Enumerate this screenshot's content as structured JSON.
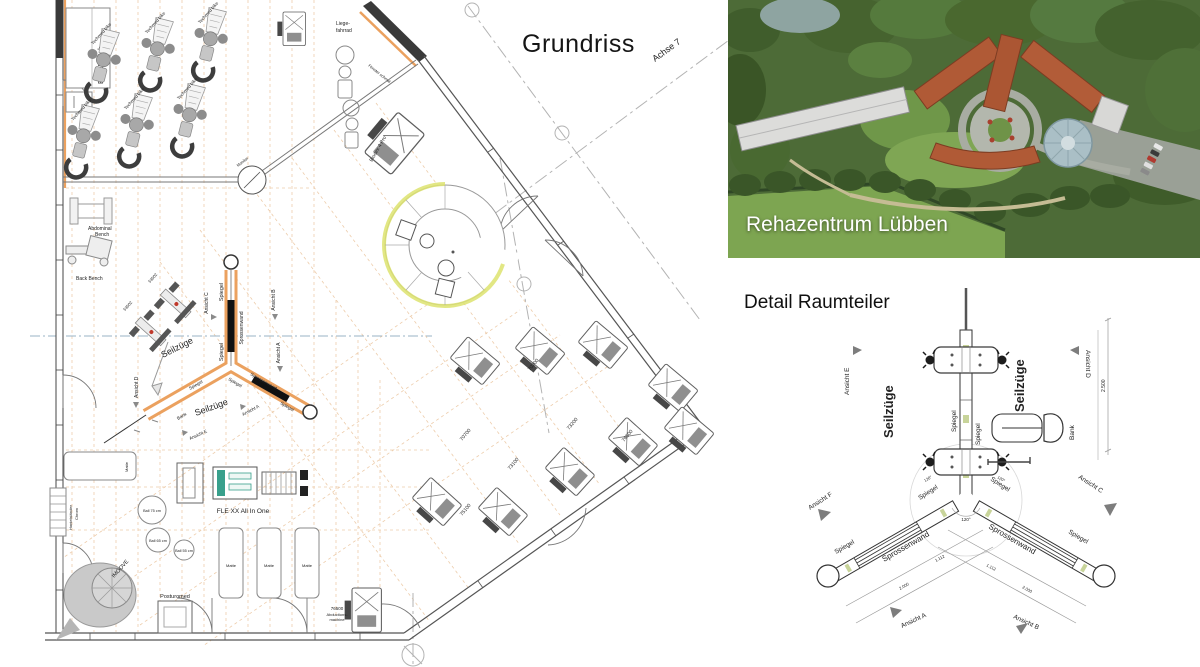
{
  "fp": {
    "title": "Grundriss",
    "achse": "Achse 7",
    "elt": "ELT-UV Sch",
    "techmed": "Techmed bike",
    "liege1": "Liege-",
    "liege2": "fahrrad",
    "biodex": "Biodex 4 Pro",
    "monitor": "Monitor",
    "fenster": "Fenster schmal",
    "abdominal1": "Abdominal",
    "abdominal2": "Bench",
    "backbench": "Back Bench",
    "m53502": "53502",
    "seilzuege": "Seilzüge",
    "spiegel": "Spiegel",
    "sprossenwand": "Sprossenwand",
    "bank": "Bank",
    "ansA": "Ansicht A",
    "ansB": "Ansicht B",
    "ansC": "Ansicht C",
    "ansD": "Ansicht D",
    "ansE": "Ansicht E",
    "flexx": "FLE XX All In One",
    "ball75": "Ball 75 cm",
    "ball65": "Ball 65 cm",
    "ball55": "Ball 55 cm",
    "imoove": "IMOOVE",
    "posturomed": "Posturomed",
    "matte": "Matte",
    "hantel1": "Hantelständer",
    "hantel2": "Chrom",
    "n70700": "70700",
    "n70200": "70200",
    "n73100": "73100",
    "n73200": "73200",
    "n76500": "76500",
    "n75100": "75100",
    "abd1": "76500",
    "abd2": "Abductions-",
    "abd3": "machine"
  },
  "photo": {
    "caption": "Rehazentrum Lübben"
  },
  "dt": {
    "title": "Detail Raumteiler",
    "seilzuege": "Seilzüge",
    "spiegel": "Spiegel",
    "sprossenwand": "Sprossenwand",
    "bank": "Bank",
    "ansA": "Ansicht A",
    "ansB": "Ansicht B",
    "ansC": "Ansicht C",
    "ansD": "Ansicht D",
    "ansE": "Ansicht E",
    "ansF": "Ansicht F",
    "dim2500": "2.500",
    "dim2000": "2.000",
    "dim1112": "1.112",
    "angle120": "120°"
  },
  "colors": {
    "wall_accent": "#eba15f",
    "grid_orange": "#dfa467",
    "highlight_green": "#dde36e",
    "machine_teal": "#38a08c",
    "roof_orange": "#b05a36"
  }
}
